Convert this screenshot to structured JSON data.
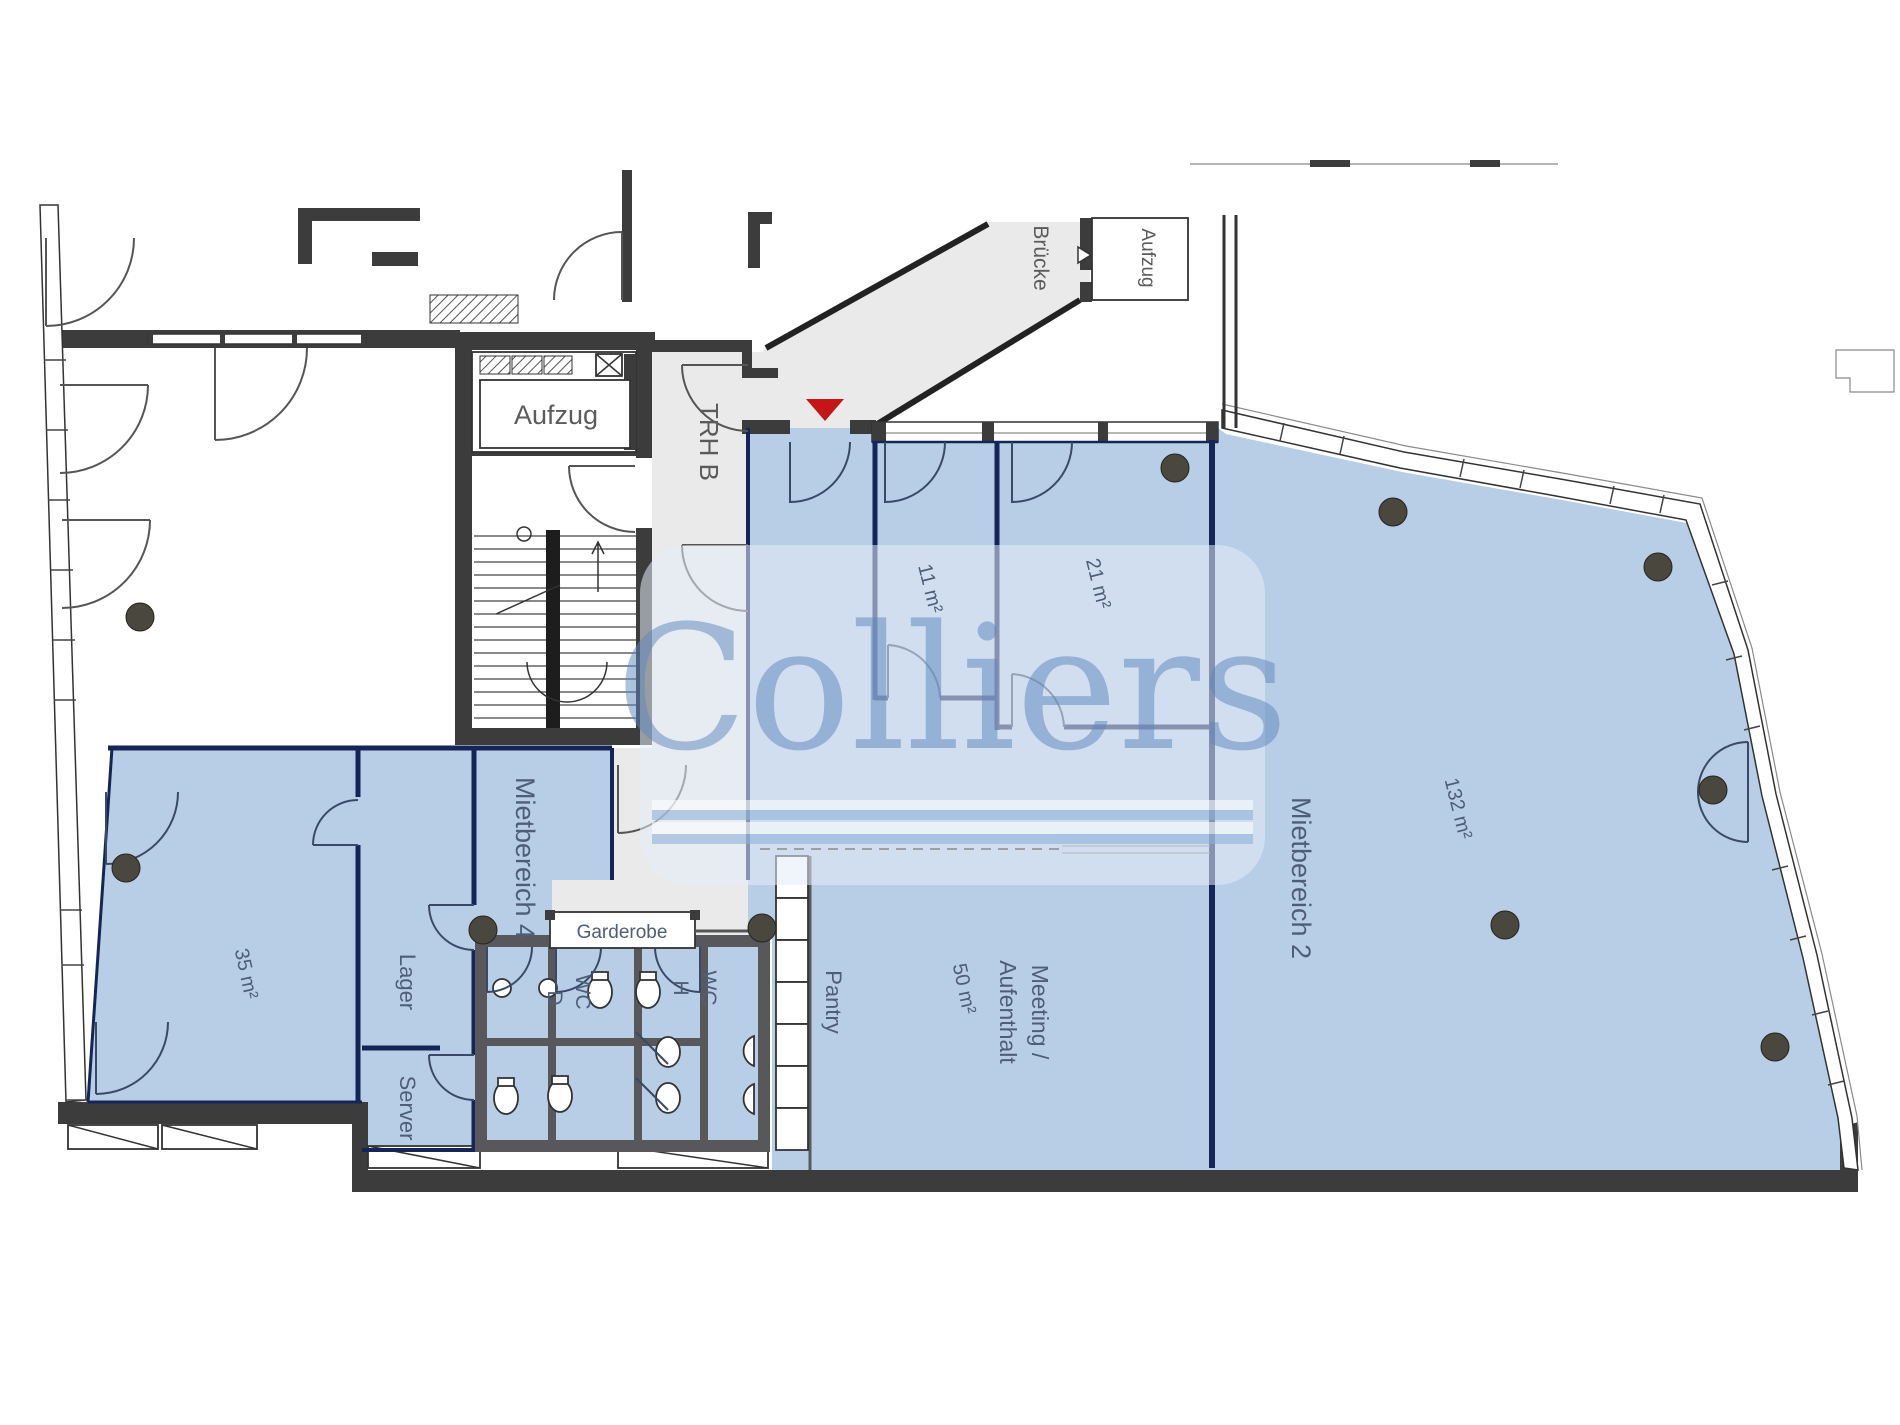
{
  "plan": {
    "brand_watermark": "Colliers",
    "labels": {
      "elevator_core": "Aufzug",
      "elevator_bridge": "Aufzug",
      "stairwell": "TRH B",
      "bridge": "Brücke",
      "cloakroom": "Garderobe",
      "storage": "Lager",
      "server": "Server",
      "pantry": "Pantry",
      "wc": "WC",
      "wc_women": "D",
      "wc_men": "H",
      "meeting_line1": "Meeting /",
      "meeting_line2": "Aufenthalt",
      "rental_area_2": "Mietbereich 2",
      "rental_area_4": "Mietbereich 4"
    },
    "areas": {
      "room_35": "35 m²",
      "room_11": "11 m²",
      "room_21": "21 m²",
      "room_132": "132 m²",
      "room_50": "50 m²"
    },
    "colors": {
      "rentable_fill": "#b8cde6",
      "wall_dark": "#3c3c3c",
      "wc_wall_gray": "#58585c",
      "partition_navy": "#152557",
      "corridor_gray": "#eaeaea",
      "label_text": "#4e5e76",
      "entry_marker_red": "#c41616",
      "watermark_blue": "#5d86bd",
      "column_gray": "#4a473e"
    }
  }
}
